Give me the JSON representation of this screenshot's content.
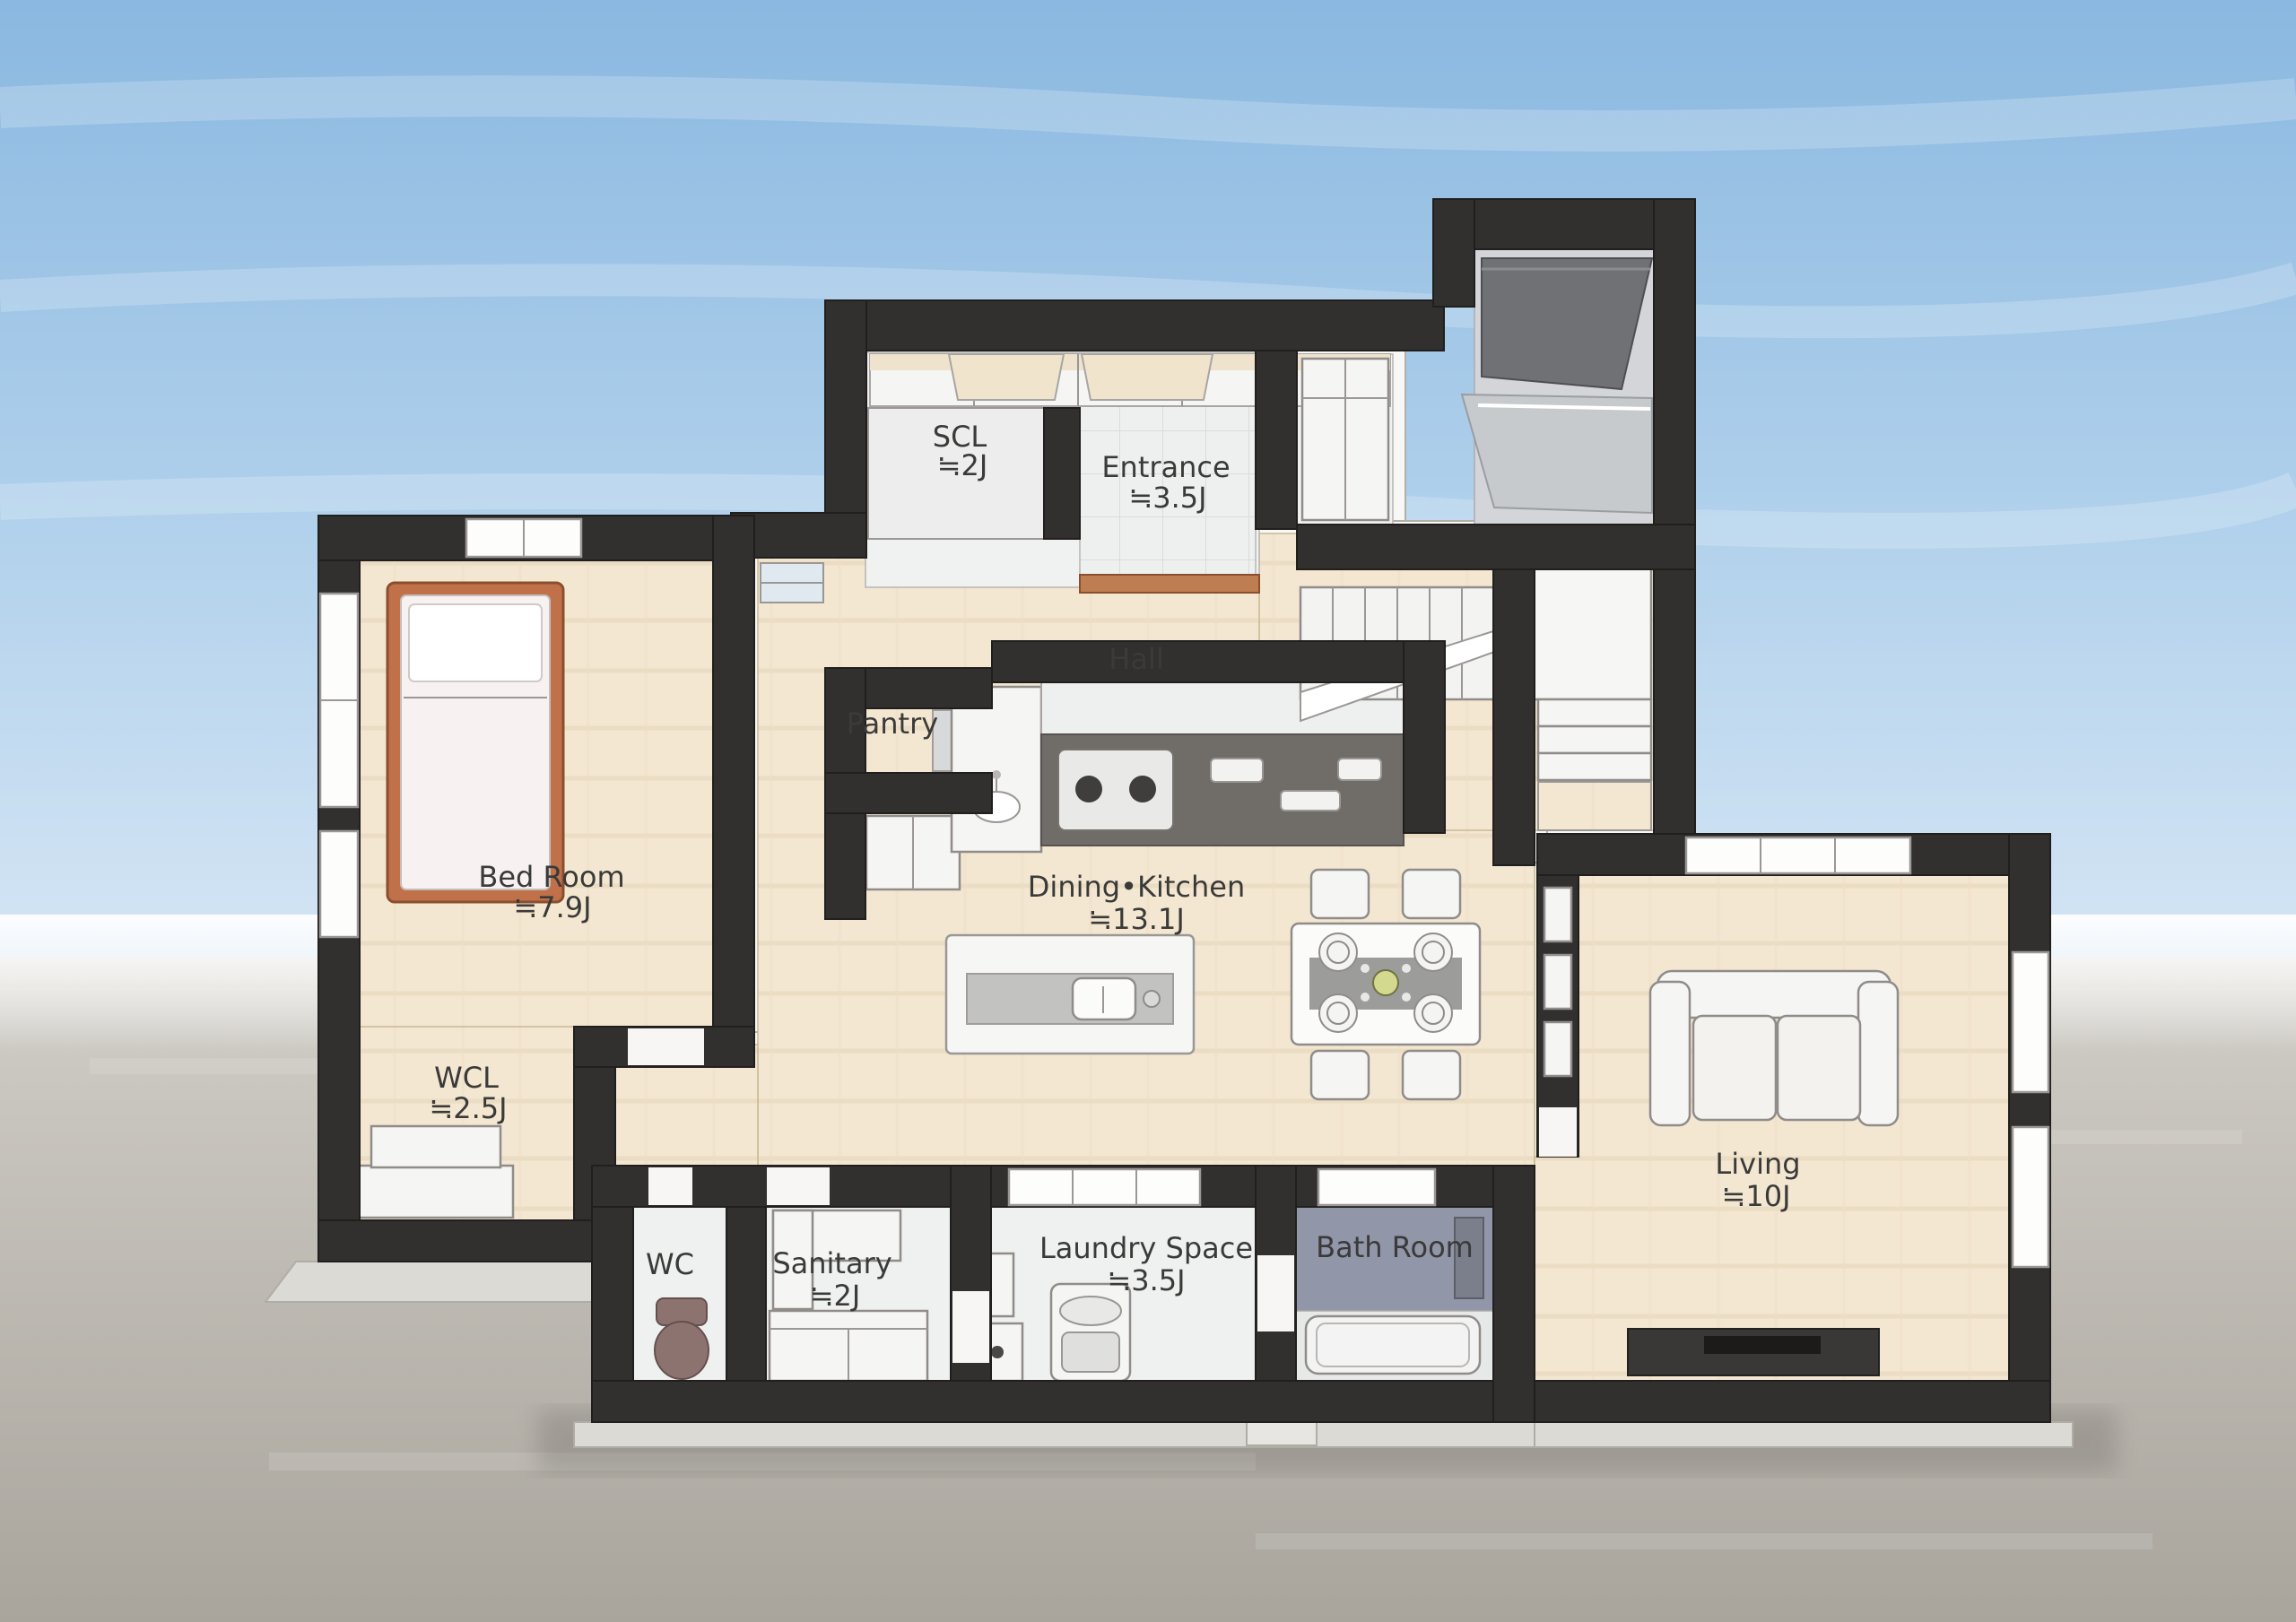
{
  "scene": {
    "description": "Watercolor-style 3D bird's-eye floor plan of a single floor of a house, on a blue sky and grey ground background",
    "palette": {
      "sky_top": "#8ab8e0",
      "sky_bottom": "#f8fafa",
      "ground": "#a9a59d",
      "wall": "#31302e",
      "wood_floor": "#f3e7d2",
      "tile_floor": "#eff0f0",
      "bath_floor": "#9296a9",
      "bed_frame": "#c0714a",
      "step_wood": "#bf7d52",
      "toilet": "#8d7370",
      "label_text": "#3a3a38"
    }
  },
  "rooms": [
    {
      "id": "scl",
      "label": "SCL",
      "size": "≒2J"
    },
    {
      "id": "entrance",
      "label": "Entrance",
      "size": "≒3.5J"
    },
    {
      "id": "hall",
      "label": "Hall",
      "size": ""
    },
    {
      "id": "pantry",
      "label": "Pantry",
      "size": ""
    },
    {
      "id": "bed-room",
      "label": "Bed Room",
      "size": "≒7.9J"
    },
    {
      "id": "dining-kitchen",
      "label": "Dining•Kitchen",
      "size": "≒13.1J"
    },
    {
      "id": "wcl",
      "label": "WCL",
      "size": "≒2.5J"
    },
    {
      "id": "wc",
      "label": "WC",
      "size": ""
    },
    {
      "id": "sanitary",
      "label": "Sanitary",
      "size": "≒2J"
    },
    {
      "id": "laundry-space",
      "label": "Laundry Space",
      "size": "≒3.5J"
    },
    {
      "id": "bath-room",
      "label": "Bath Room",
      "size": ""
    },
    {
      "id": "living",
      "label": "Living",
      "size": "≒10J"
    }
  ],
  "furniture": [
    "bed",
    "closet-row",
    "shoe-closet",
    "pantry-shelf",
    "wash-basin-cabinet",
    "kitchen-counter",
    "gas-stove",
    "kitchen-island",
    "island-sink",
    "dining-table",
    "dining-chairs",
    "plates",
    "staircase",
    "stair-landing",
    "glass-console",
    "sofa",
    "tv-board",
    "under-window-shelf",
    "washing-machine",
    "laundry-cabinet",
    "vanity-counter",
    "toilet",
    "bathtub",
    "shower-column",
    "porch-roof"
  ]
}
